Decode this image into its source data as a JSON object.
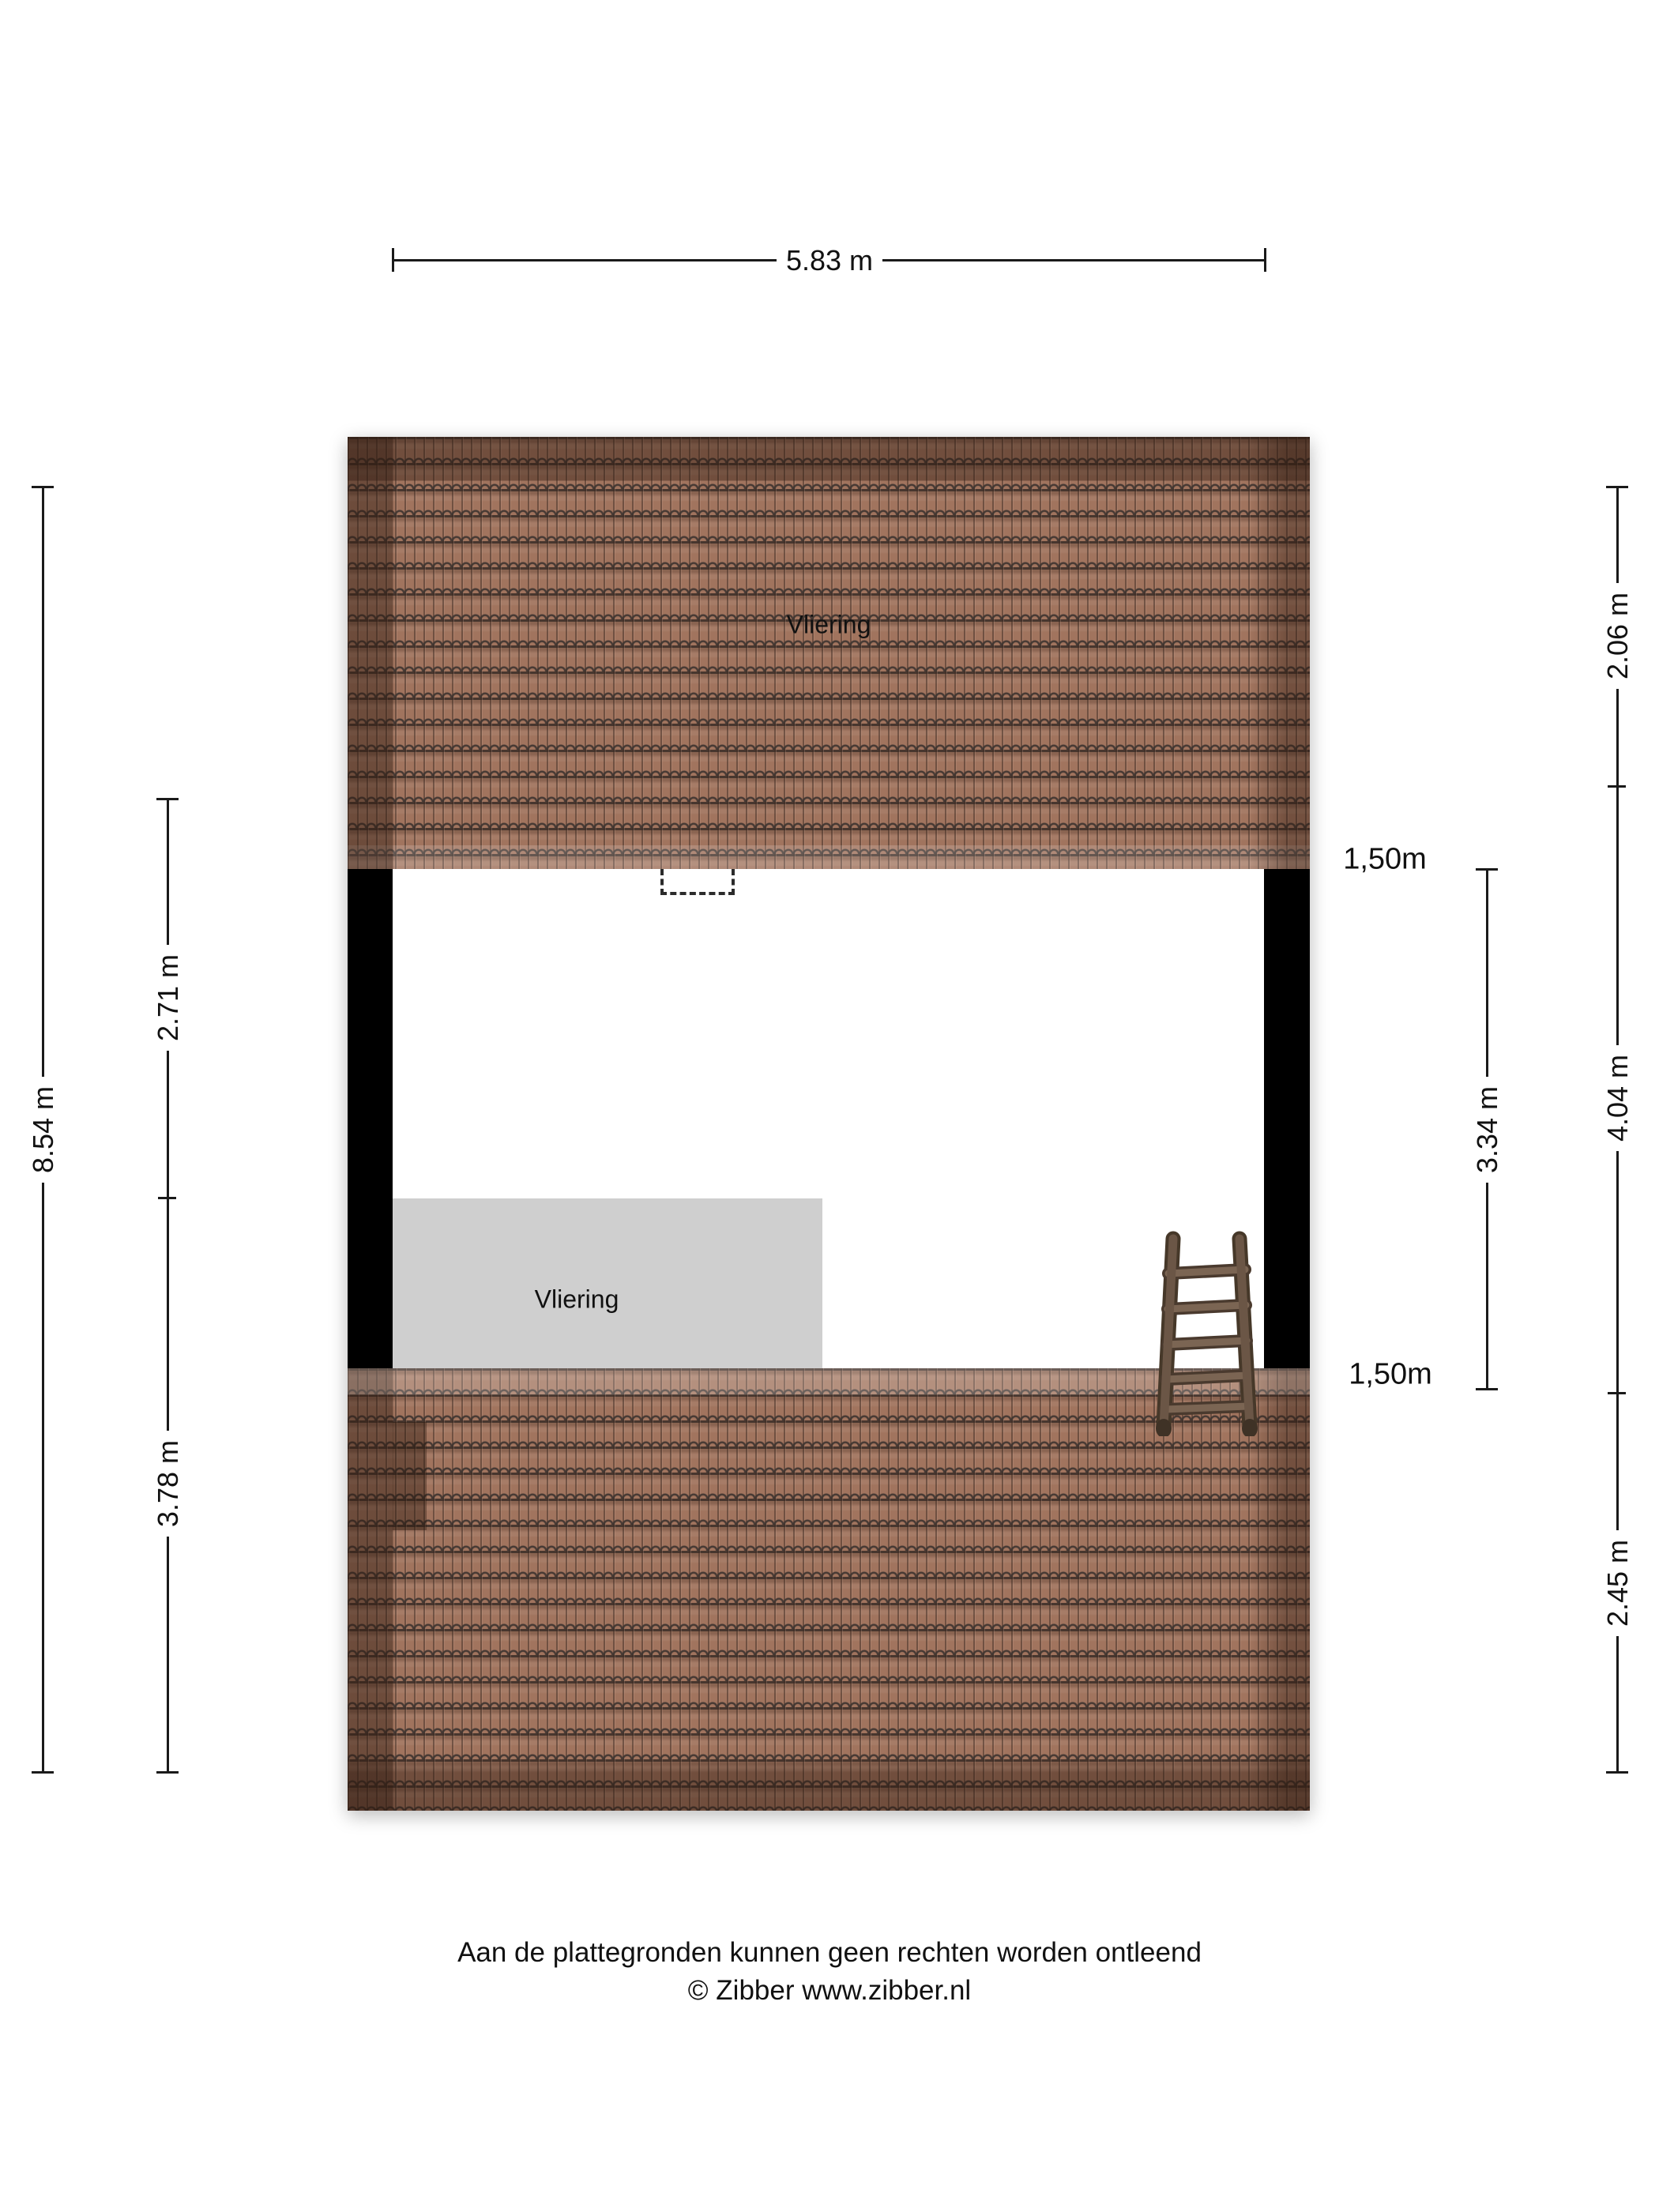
{
  "plan": {
    "rooms": {
      "attic": {
        "label": "Vliering"
      },
      "mezzanine": {
        "label": "Vliering"
      }
    }
  },
  "dimensions": {
    "width_top": "5.83 m",
    "height_total_left": "8.54 m",
    "left_upper": "2.71 m",
    "left_lower": "3.78 m",
    "right_top": "2.06 m",
    "right_middle": "4.04 m",
    "right_bottom": "2.45 m",
    "right_inner": "3.34 m",
    "knee_wall_top": "1,50m",
    "knee_wall_bottom": "1,50m"
  },
  "colors": {
    "roof_tile": "#a1745e",
    "roof_tile_line": "#3c332f",
    "wall": "#000000",
    "mezzanine_fill": "#cfcfcf",
    "ladder_wood": "#6b5646",
    "dimension_ink": "#1a1a1a"
  },
  "footer": {
    "disclaimer": "Aan de plattegronden kunnen geen rechten worden ontleend",
    "copyright": "© Zibber www.zibber.nl"
  }
}
